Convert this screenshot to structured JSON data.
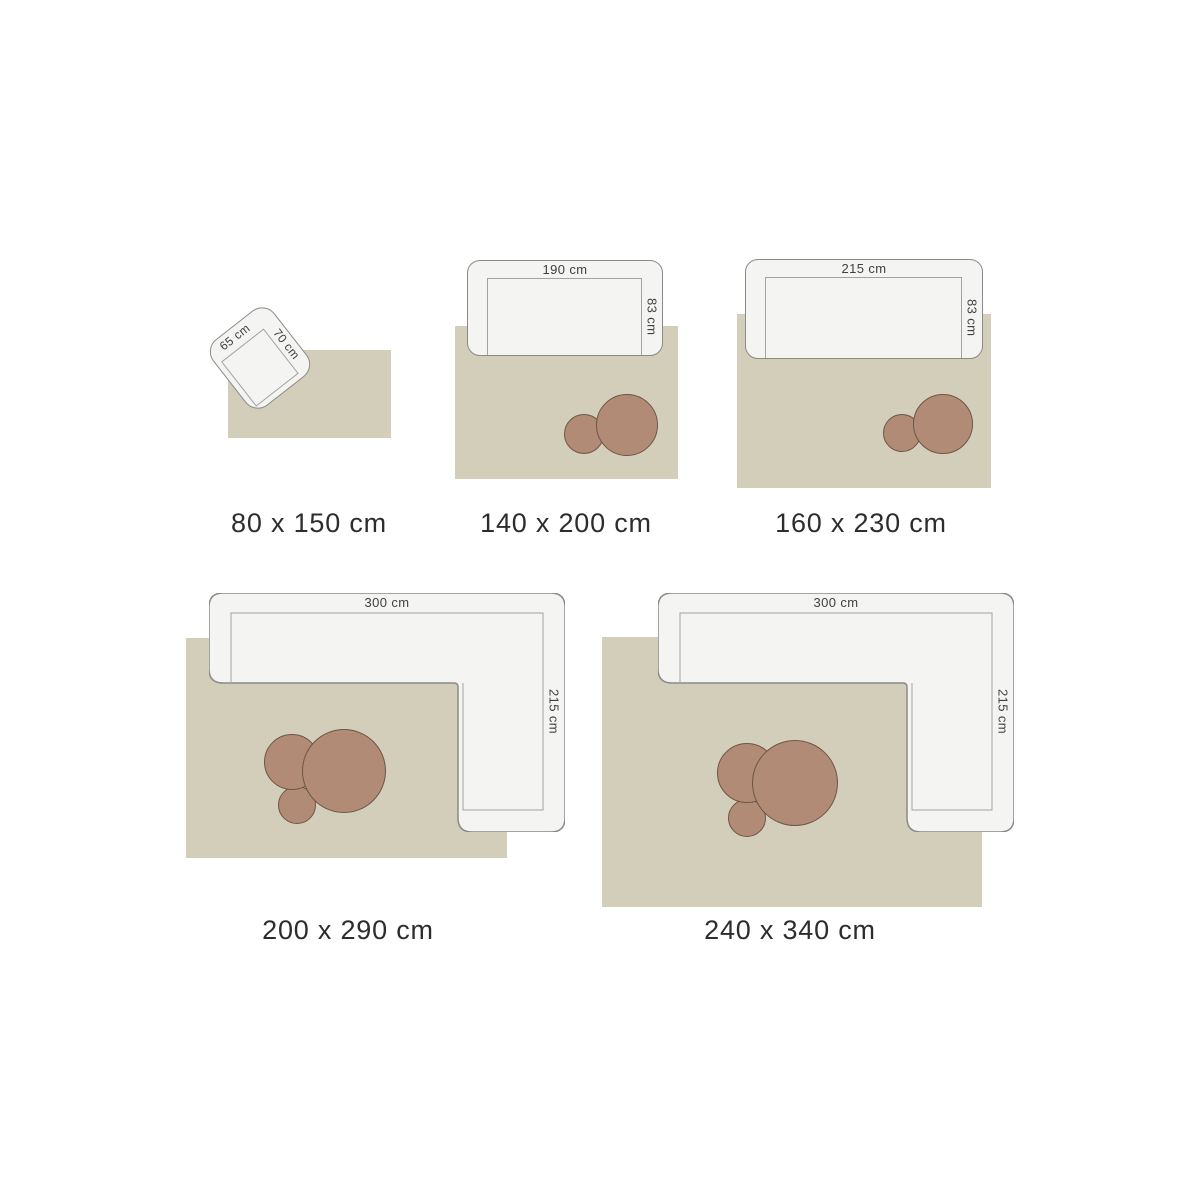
{
  "colors": {
    "background": "#ffffff",
    "rug": "#d2ceba",
    "sofa_fill": "#f4f4f2",
    "sofa_border": "#8a8a88",
    "inner_line": "#a2a2a0",
    "pouf_fill": "#b28b77",
    "pouf_border": "#6d5645",
    "size_label_color": "#2d2d2d",
    "dim_label_color": "#404040"
  },
  "items": [
    {
      "size_label": "80 x 150 cm",
      "furniture_type": "armchair",
      "width_label": "65 cm",
      "depth_label": "70 cm"
    },
    {
      "size_label": "140 x 200 cm",
      "furniture_type": "sofa",
      "width_label": "190 cm",
      "depth_label": "83 cm"
    },
    {
      "size_label": "160 x 230 cm",
      "furniture_type": "sofa",
      "width_label": "215 cm",
      "depth_label": "83 cm"
    },
    {
      "size_label": "200 x 290 cm",
      "furniture_type": "corner-sofa",
      "width_label": "300 cm",
      "depth_label": "215 cm"
    },
    {
      "size_label": "240 x 340 cm",
      "furniture_type": "corner-sofa",
      "width_label": "300 cm",
      "depth_label": "215 cm"
    }
  ]
}
